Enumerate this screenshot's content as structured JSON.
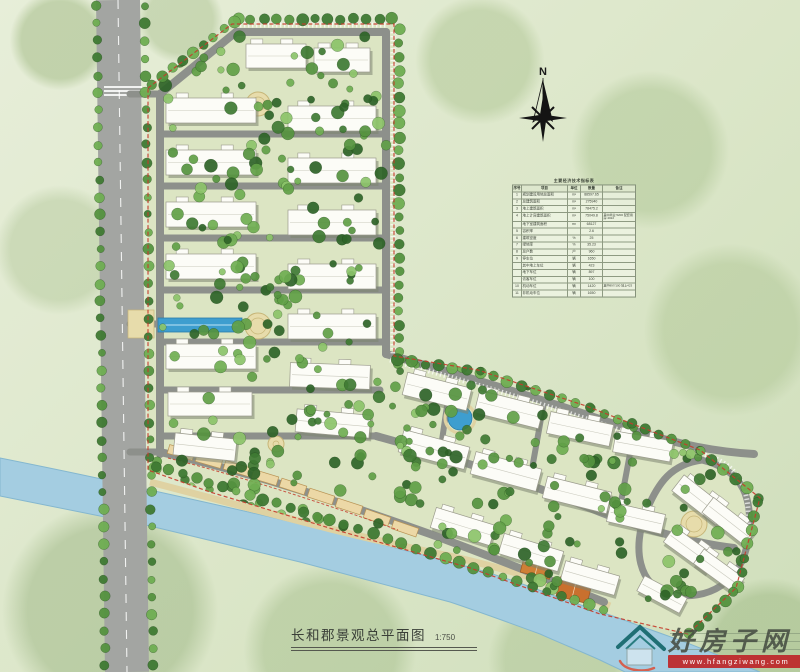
{
  "page": {
    "title_text": "长和郡景观总平面图",
    "scale_label": "1:750"
  },
  "compass": {
    "label": "N"
  },
  "watermark": {
    "site_name": "好房子网",
    "site_url": "www.hfangziwang.com",
    "logo": "house-icon",
    "bar_color": "#be2628"
  },
  "table": {
    "title": "主要经济技术指标表",
    "headers": [
      "序号",
      "项目",
      "单位",
      "数量",
      "备注"
    ],
    "rows": [
      [
        "1",
        "规划建设用地总面积",
        "m²",
        "88597.65",
        ""
      ],
      [
        "2",
        "总建筑面积",
        "m²",
        "275940",
        ""
      ],
      [
        "3",
        "地上建筑面积",
        "m²",
        "78475.2",
        ""
      ],
      [
        "4",
        "地上计容建筑面积",
        "m²",
        "75049.8",
        "其中商业:5200 配套用房:4022"
      ],
      [
        "",
        "地下室建筑面积",
        "m²",
        "68127",
        ""
      ],
      [
        "5",
        "容积率",
        "",
        "2.6",
        ""
      ],
      [
        "6",
        "建筑密度",
        "%",
        "25",
        ""
      ],
      [
        "7",
        "绿地率",
        "%",
        "35.23",
        ""
      ],
      [
        "8",
        "总户数",
        "户",
        "960",
        ""
      ],
      [
        "9",
        "停车位",
        "辆",
        "1650",
        ""
      ],
      [
        "",
        "其中地上车位",
        "辆",
        "423",
        ""
      ],
      [
        "",
        "地下车位",
        "辆",
        "897",
        ""
      ],
      [
        "",
        "访客车位",
        "辆",
        "100",
        ""
      ],
      [
        "10",
        "机动车位",
        "辆",
        "1420",
        "其中897/100  地上423"
      ],
      [
        "11",
        "非机动车位",
        "辆",
        "1650",
        ""
      ]
    ]
  },
  "map": {
    "seed": 20240117,
    "colors": {
      "site_ground": "#dce5c3",
      "road_city": "#a3a5a2",
      "road_site": "#8d908b",
      "road_line": "#ffffff",
      "river": "#a4cde1",
      "river_edge": "#84b7cf",
      "building": "#fcfcf7",
      "building_stroke": "#9b9b8d",
      "building_shadow": "#7e8571",
      "boundary_red": "#c53b2b",
      "promenade": "#dfd2a2",
      "commercial": "#ecd8a6",
      "commercial_stroke": "#b99455",
      "plaza": "#e7dcab",
      "plaza_stroke": "#c7b678",
      "pool": "#3e9ecf",
      "court_a": "#cf7f36",
      "court_b": "#c9702e",
      "tree_greens": [
        "#3f7a33",
        "#55933f",
        "#6fae52",
        "#8cc46a",
        "#2e6428",
        "#61a047"
      ]
    },
    "site_polygon": "148,88 232,24 394,24 394,356 478,370 586,406 700,450 760,498 736,588 688,634 600,614 470,568 336,530 210,492 148,470",
    "river_path": "M0,458 C50,468 100,478 150,490 C200,501 250,512 300,524 C350,536 400,549 450,562 C487,571 524,584 560,598 C587,607 614,616 640,626 C660,633 680,640 700,648 C720,656 740,664 760,672 L625,672 C617,668 608,664 600,660 C580,651 560,643 540,634 C510,623 480,612 450,602 C400,589 350,575 300,562 C250,550 200,538 150,526 C100,516 50,506 0,496 Z",
    "promenade_path": "M150,482 C250,508 350,536 450,556 C520,572 560,586 610,606",
    "city_road": {
      "d": "M118,0 L127,672",
      "w": 44
    },
    "crosswalk": [
      {
        "x": 104,
        "y": 86,
        "w": 38,
        "h": 2
      },
      {
        "x": 104,
        "y": 90,
        "w": 38,
        "h": 2
      },
      {
        "x": 104,
        "y": 94,
        "w": 38,
        "h": 2
      }
    ],
    "roads": [
      {
        "d": "M236,32 H386",
        "w": 8
      },
      {
        "d": "M160,94 L236,32",
        "w": 8
      },
      {
        "d": "M160,94 V454",
        "w": 8
      },
      {
        "d": "M386,32 V354",
        "w": 8
      },
      {
        "d": "M160,134 H386",
        "w": 7
      },
      {
        "d": "M160,186 H386",
        "w": 7
      },
      {
        "d": "M160,238 H386",
        "w": 7
      },
      {
        "d": "M160,290 H386",
        "w": 7
      },
      {
        "d": "M160,342 H386",
        "w": 7
      },
      {
        "d": "M160,390 H380",
        "w": 7
      },
      {
        "d": "M162,436 H374",
        "w": 7
      },
      {
        "d": "M130,94 H160",
        "w": 7
      },
      {
        "d": "M130,324 H158",
        "w": 7
      },
      {
        "d": "M130,452 H160",
        "w": 7
      },
      {
        "d": "M386,354 C450,372 540,398 620,426 C680,446 720,452 754,454",
        "w": 8
      },
      {
        "d": "M376,436 C450,456 530,484 600,512 C650,532 700,544 734,548",
        "w": 8
      },
      {
        "d": "M452,372 L440,454",
        "w": 6
      },
      {
        "d": "M544,402 L530,480",
        "w": 6
      },
      {
        "d": "M634,432 L618,518",
        "w": 6
      },
      {
        "d": "M702,460 C744,470 754,500 748,540 C742,582 708,602 670,594 C638,586 632,548 646,512 C658,482 672,464 702,460",
        "w": 7
      },
      {
        "d": "M160,452 C250,472 340,502 430,534 C490,556 550,580 604,602",
        "w": 8
      }
    ],
    "parking_dashes": [
      {
        "d": "M236,25 H388",
        "w": 5
      },
      {
        "d": "M393,32 V354",
        "w": 5
      },
      {
        "d": "M390,360 C455,378 545,404 625,432",
        "w": 5
      },
      {
        "d": "M705,455 C745,466 752,498 747,540",
        "w": 5
      }
    ],
    "boundary_extra": [
      "M168,458 C240,476 320,502 398,530"
    ],
    "commercial": [
      [
        168,
        448,
        26,
        9,
        16
      ],
      [
        196,
        456,
        26,
        9,
        16
      ],
      [
        224,
        464,
        26,
        9,
        17
      ],
      [
        252,
        473,
        26,
        9,
        17
      ],
      [
        280,
        482,
        26,
        9,
        18
      ],
      [
        308,
        492,
        26,
        9,
        18
      ],
      [
        336,
        502,
        26,
        9,
        18
      ],
      [
        364,
        513,
        26,
        9,
        19
      ],
      [
        392,
        524,
        26,
        9,
        19
      ]
    ],
    "buildings": [
      [
        246,
        44,
        60,
        24,
        0
      ],
      [
        314,
        48,
        56,
        24,
        0
      ],
      [
        166,
        98,
        90,
        25,
        0
      ],
      [
        166,
        150,
        90,
        25,
        0
      ],
      [
        166,
        202,
        90,
        25,
        0
      ],
      [
        166,
        254,
        90,
        25,
        0
      ],
      [
        166,
        344,
        90,
        25,
        0
      ],
      [
        168,
        392,
        84,
        24,
        0
      ],
      [
        174,
        436,
        62,
        22,
        6
      ],
      [
        288,
        106,
        88,
        25,
        0
      ],
      [
        288,
        158,
        88,
        25,
        0
      ],
      [
        288,
        210,
        88,
        25,
        0
      ],
      [
        288,
        264,
        88,
        25,
        0
      ],
      [
        288,
        314,
        88,
        25,
        0
      ],
      [
        290,
        364,
        80,
        24,
        2
      ],
      [
        296,
        412,
        74,
        23,
        5
      ],
      [
        404,
        380,
        66,
        23,
        14
      ],
      [
        476,
        398,
        66,
        23,
        14
      ],
      [
        548,
        418,
        64,
        22,
        12
      ],
      [
        614,
        436,
        58,
        21,
        10
      ],
      [
        400,
        438,
        68,
        23,
        15
      ],
      [
        472,
        460,
        68,
        23,
        15
      ],
      [
        544,
        484,
        66,
        22,
        14
      ],
      [
        608,
        508,
        56,
        20,
        13
      ],
      [
        432,
        516,
        62,
        21,
        17
      ],
      [
        500,
        542,
        62,
        21,
        17
      ],
      [
        562,
        568,
        56,
        20,
        16
      ],
      [
        672,
        490,
        56,
        20,
        38
      ],
      [
        702,
        512,
        54,
        19,
        38
      ],
      [
        664,
        540,
        52,
        19,
        36
      ],
      [
        694,
        562,
        50,
        18,
        36
      ],
      [
        638,
        586,
        48,
        17,
        28
      ]
    ],
    "pools": [
      {
        "x": 158,
        "y": 318,
        "w": 84,
        "h": 14
      }
    ],
    "entry_pads": [
      {
        "x": 128,
        "y": 310,
        "w": 26,
        "h": 28
      }
    ],
    "plazas": [
      {
        "cx": 258,
        "cy": 104,
        "r": 12
      },
      {
        "cx": 258,
        "cy": 326,
        "r": 13
      },
      {
        "cx": 694,
        "cy": 524,
        "r": 13
      },
      {
        "cx": 276,
        "cy": 444,
        "r": 8
      }
    ],
    "water_circles": [
      {
        "cx": 460,
        "cy": 418,
        "r": 12
      }
    ],
    "courts": [
      {
        "x": 522,
        "y": 558,
        "w": 30,
        "h": 18,
        "r": 14
      },
      {
        "x": 558,
        "y": 580,
        "w": 32,
        "h": 20,
        "r": 14
      }
    ],
    "tree_regions": [
      {
        "x": 162,
        "y": 36,
        "w": 226,
        "h": 62,
        "n": 26
      },
      {
        "x": 162,
        "y": 96,
        "w": 228,
        "h": 340,
        "n": 150
      },
      {
        "x": 390,
        "y": 356,
        "w": 370,
        "h": 112,
        "n": 80
      },
      {
        "x": 396,
        "y": 450,
        "w": 352,
        "h": 172,
        "n": 95
      },
      {
        "x": 150,
        "y": 430,
        "w": 300,
        "h": 102,
        "n": 55
      }
    ],
    "tree_lines": [
      {
        "x1": 97,
        "y1": 6,
        "x2": 105,
        "y2": 666,
        "step": 17,
        "r": 4.5
      },
      {
        "x1": 145,
        "y1": 6,
        "x2": 153,
        "y2": 666,
        "step": 17,
        "r": 4.5
      },
      {
        "x1": 238,
        "y1": 19,
        "x2": 392,
        "y2": 19,
        "step": 12,
        "r": 5
      },
      {
        "x1": 152,
        "y1": 84,
        "x2": 234,
        "y2": 21,
        "step": 12,
        "r": 5
      },
      {
        "x1": 399,
        "y1": 30,
        "x2": 399,
        "y2": 352,
        "step": 13,
        "r": 5
      },
      {
        "x1": 398,
        "y1": 360,
        "x2": 480,
        "y2": 372,
        "step": 13,
        "r": 5
      },
      {
        "x1": 480,
        "y1": 372,
        "x2": 590,
        "y2": 408,
        "step": 13,
        "r": 5
      },
      {
        "x1": 590,
        "y1": 408,
        "x2": 700,
        "y2": 450,
        "step": 14,
        "r": 5
      },
      {
        "x1": 700,
        "y1": 450,
        "x2": 758,
        "y2": 498,
        "step": 13,
        "r": 5
      },
      {
        "x1": 758,
        "y1": 502,
        "x2": 738,
        "y2": 586,
        "step": 13,
        "r": 5
      },
      {
        "x1": 734,
        "y1": 592,
        "x2": 690,
        "y2": 634,
        "step": 12,
        "r": 5
      },
      {
        "x1": 156,
        "y1": 466,
        "x2": 330,
        "y2": 520,
        "step": 14,
        "r": 5
      },
      {
        "x1": 330,
        "y1": 520,
        "x2": 604,
        "y2": 610,
        "step": 15,
        "r": 5
      }
    ]
  }
}
